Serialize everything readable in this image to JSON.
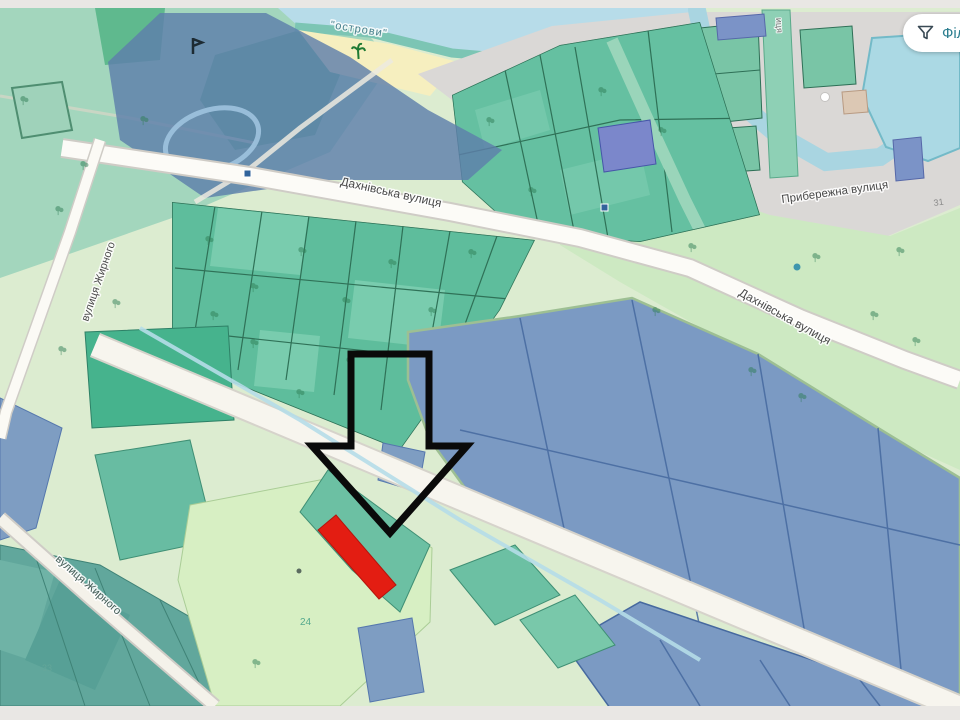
{
  "app": {
    "filter_button": {
      "label": "Філ",
      "icon": "funnel-icon"
    }
  },
  "map": {
    "street_labels": {
      "dakhnivska": "Дахнівська вулиця",
      "pryberezhna": "Прибережна вулиця",
      "zhyrnoho": "вулиця Жирного",
      "vertical_fragment": "иця"
    },
    "area_labels": {
      "islands": "\"острови\""
    },
    "parcel_labels": {
      "p24": "24",
      "p33": "33",
      "h31": "31"
    },
    "colors": {
      "water": "#b7dce9",
      "mint_park": "#a3d6bd",
      "parcel_teal": "#5ebd9c",
      "parcel_blue_gray": "#7b9ac3",
      "blue_overlay": "#5e7fab",
      "shore_gray": "#dad8d6",
      "road": "#f7f5ee",
      "beach": "#f6efbf",
      "highlight_red": "#e31d12",
      "arrow_black": "#0a0a0a",
      "button_text": "#2c7e8f"
    }
  }
}
